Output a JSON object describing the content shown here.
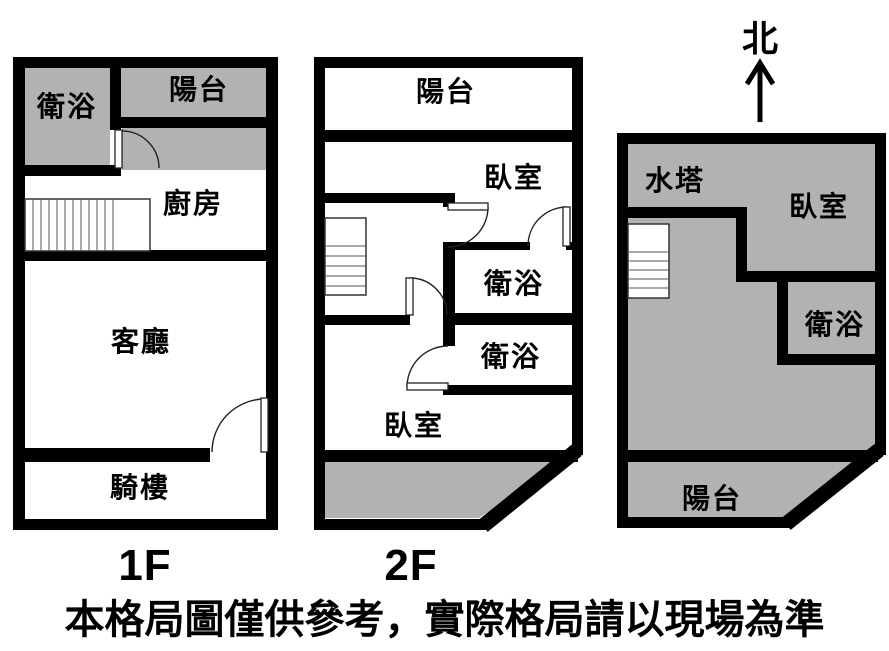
{
  "compass": {
    "label": "北"
  },
  "floor1": {
    "label": "1F",
    "rooms": {
      "bath": "衛浴",
      "balcony": "陽台",
      "kitchen": "廚房",
      "living": "客廳",
      "arcade": "騎樓"
    }
  },
  "floor2": {
    "label": "2F",
    "rooms": {
      "balcony": "陽台",
      "bedroom_front": "臥室",
      "bath_upper": "衛浴",
      "bath_lower": "衛浴",
      "bedroom_back": "臥室"
    }
  },
  "floor3": {
    "rooms": {
      "water_tower": "水塔",
      "bedroom": "臥室",
      "bath": "衛浴",
      "balcony": "陽台"
    }
  },
  "disclaimer": "本格局圖僅供參考，實際格局請以現場為準",
  "colors": {
    "wall": "#000000",
    "gray_fill": "#b2b2b2",
    "background": "#ffffff",
    "text": "#000000"
  }
}
